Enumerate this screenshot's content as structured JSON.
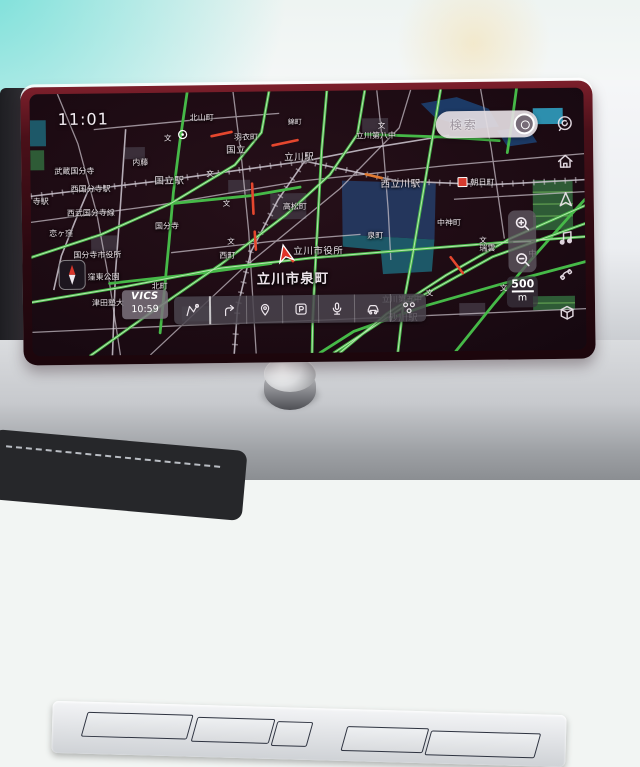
{
  "colors": {
    "accent_green": "#46b948",
    "map_background": "#1d0b13",
    "bezel_red": "#4a1019",
    "congestion_red": "#e5472e",
    "water_blue": "#1c3a66",
    "park_teal": "#1d5868"
  },
  "screen": {
    "clock": "11:01",
    "search": {
      "label": "検索",
      "icon": "mic-icon"
    },
    "vics": {
      "label": "VICS",
      "time": "10:59"
    },
    "scale": {
      "value": "500",
      "unit": "m"
    },
    "sidebar": {
      "items": [
        {
          "icon": "voice-assistant-icon"
        },
        {
          "icon": "home-icon"
        },
        {
          "icon": "navigation-icon"
        },
        {
          "icon": "music-icon"
        },
        {
          "icon": "phone-icon"
        },
        {
          "icon": "apps-cube-icon"
        }
      ]
    },
    "toolbar": {
      "buttons": [
        {
          "name": "route",
          "icon": "route-icon"
        },
        {
          "name": "guidance",
          "icon": "turn-arrow-icon"
        },
        {
          "name": "pin",
          "icon": "pin-icon"
        },
        {
          "name": "parking",
          "icon": "parking-icon"
        },
        {
          "name": "voice",
          "icon": "mic-icon"
        },
        {
          "name": "traffic",
          "icon": "car-icon"
        },
        {
          "name": "poi",
          "icon": "poi-dots-icon"
        }
      ]
    },
    "map": {
      "school_symbol": "文",
      "labels": [
        {
          "text": "北山町",
          "x": 160,
          "y": 20,
          "size": "s"
        },
        {
          "text": "錦町",
          "x": 258,
          "y": 26,
          "size": "xs"
        },
        {
          "text": "羽衣町",
          "x": 204,
          "y": 40,
          "size": "s"
        },
        {
          "text": "国立",
          "x": 196,
          "y": 50,
          "size": "m"
        },
        {
          "text": "立川第八中",
          "x": 326,
          "y": 40,
          "size": "s"
        },
        {
          "text": "内藤",
          "x": 102,
          "y": 64,
          "size": "s"
        },
        {
          "text": "武蔵国分寺",
          "x": 24,
          "y": 72,
          "size": "s"
        },
        {
          "text": "立川駅",
          "x": 254,
          "y": 58,
          "size": "m"
        },
        {
          "text": "国立駅",
          "x": 124,
          "y": 80,
          "size": "m"
        },
        {
          "text": "西国分寺駅",
          "x": 40,
          "y": 90,
          "size": "s"
        },
        {
          "text": "西立川駅",
          "x": 350,
          "y": 86,
          "size": "m"
        },
        {
          "text": "朝日町",
          "x": 440,
          "y": 88,
          "size": "s"
        },
        {
          "text": "寺駅",
          "x": 2,
          "y": 102,
          "size": "s"
        },
        {
          "text": "西武国分寺線",
          "x": 36,
          "y": 114,
          "size": "s"
        },
        {
          "text": "高松町",
          "x": 252,
          "y": 110,
          "size": "s"
        },
        {
          "text": "恋ヶ窪",
          "x": 18,
          "y": 134,
          "size": "s"
        },
        {
          "text": "国分寺",
          "x": 124,
          "y": 128,
          "size": "s"
        },
        {
          "text": "中神町",
          "x": 406,
          "y": 128,
          "size": "s"
        },
        {
          "text": "泉町",
          "x": 336,
          "y": 140,
          "size": "s"
        },
        {
          "text": "立川市役所",
          "x": 262,
          "y": 152,
          "size": "m"
        },
        {
          "text": "瑞雲",
          "x": 448,
          "y": 154,
          "size": "s"
        },
        {
          "text": "中",
          "x": 497,
          "y": 160,
          "size": "s"
        },
        {
          "text": "国分寺市役所",
          "x": 42,
          "y": 156,
          "size": "s"
        },
        {
          "text": "西町",
          "x": 188,
          "y": 158,
          "size": "s"
        },
        {
          "text": "窪東公園",
          "x": 56,
          "y": 178,
          "size": "s"
        },
        {
          "text": "北町",
          "x": 120,
          "y": 188,
          "size": "s"
        },
        {
          "text": "立川市泉町",
          "x": 225,
          "y": 176,
          "size": "l"
        },
        {
          "text": "津田塾大",
          "x": 60,
          "y": 204,
          "size": "s"
        },
        {
          "text": "立川第五中",
          "x": 350,
          "y": 204,
          "size": "s"
        },
        {
          "text": "砂川駅",
          "x": 356,
          "y": 220,
          "size": "m"
        }
      ],
      "schools": [
        [
          176,
          76
        ],
        [
          192,
          106
        ],
        [
          348,
          30
        ],
        [
          448,
          146
        ],
        [
          394,
          198
        ],
        [
          196,
          144
        ],
        [
          134,
          40
        ],
        [
          468,
          194
        ]
      ]
    }
  }
}
